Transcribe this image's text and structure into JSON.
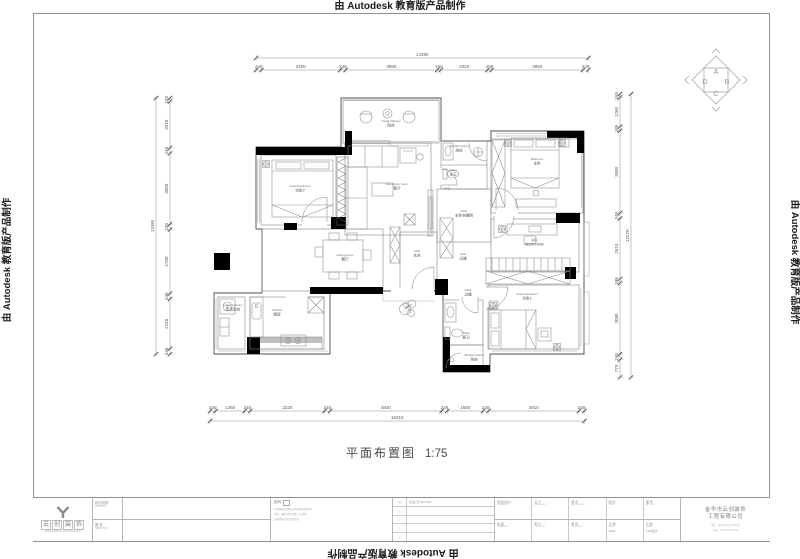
{
  "watermarks": {
    "top": "由 Autodesk 教育版产品制作",
    "bottom": "由 Autodesk 教育版产品制作",
    "left": "由 Autodesk 教育版产品制作",
    "right": "由 Autodesk 教育版产品制作"
  },
  "plan_title": {
    "name": "平面布置图",
    "scale": "1:75"
  },
  "orientation_symbol": {
    "top": "A",
    "right": "B",
    "bottom": "C",
    "left": "D"
  },
  "dimensions": {
    "top": {
      "total": "14390",
      "segments": [
        "240",
        "3400",
        "240",
        "3960",
        "160",
        "2020",
        "180",
        "3950",
        "240"
      ]
    },
    "bottom": {
      "total": "16210",
      "segments": [
        "240",
        "1260",
        "240",
        "3220",
        "240",
        "4830",
        "240",
        "1550",
        "240",
        "3910",
        "240"
      ]
    },
    "left": {
      "total": "11090",
      "segments": [
        "150",
        "2010",
        "240",
        "3060",
        "240",
        "2760",
        "240",
        "2150",
        "240"
      ]
    },
    "right": {
      "total": "12270",
      "segments": [
        "150",
        "1260",
        "180",
        "3560",
        "240",
        "2610",
        "180",
        "3080",
        "240",
        "770"
      ]
    }
  },
  "interior_dims": [
    {
      "text": "770",
      "x": 447,
      "y": 190
    }
  ],
  "rooms": [
    {
      "l1": "Living balcony",
      "l2": "阳台",
      "x": 391,
      "y": 122
    },
    {
      "l1": "Guest bedroom",
      "l2": "次卧2",
      "x": 300,
      "y": 187
    },
    {
      "l1": "Reception room",
      "l2": "客厅",
      "x": 397,
      "y": 185
    },
    {
      "l1": "Shower Room",
      "l2": "淋浴",
      "x": 459,
      "y": 147
    },
    {
      "l1": "Toilet",
      "l2": "主卫",
      "x": 453,
      "y": 171
    },
    {
      "l1": "Bedroom",
      "l2": "主卧",
      "x": 537,
      "y": 160
    },
    {
      "l1": "Aisle",
      "l2": "主卧衣帽间",
      "x": 464,
      "y": 212
    },
    {
      "l1": "Aisle",
      "l2": "玄关",
      "x": 417,
      "y": 252
    },
    {
      "l1": "Aisle",
      "l2": "过道",
      "x": 463,
      "y": 255
    },
    {
      "l1": "Aisle",
      "l2": "过道",
      "x": 468,
      "y": 291
    },
    {
      "l1": "书房",
      "l2": "BEDROOM",
      "x": 534,
      "y": 241
    },
    {
      "l1": "Dining room",
      "l2": "餐厅",
      "x": 345,
      "y": 256
    },
    {
      "l1": "Kitchen",
      "l2": "厨房",
      "x": 277,
      "y": 311
    },
    {
      "l1": "Living balcony",
      "l2": "生活阳台",
      "x": 233,
      "y": 306
    },
    {
      "l1": "Guest bedroom",
      "l2": "次卧1",
      "x": 527,
      "y": 295
    },
    {
      "l1": "Toilet",
      "l2": "客卫",
      "x": 466,
      "y": 334
    },
    {
      "l1": "Shower Room",
      "l2": "淋浴",
      "x": 474,
      "y": 356
    }
  ],
  "title_block": {
    "logo": {
      "chars": [
        "云",
        "创",
        "装",
        "饰"
      ],
      "tagline": "YUNCHUANG DECORATION"
    },
    "project_label": {
      "cn": "项目名称",
      "en": "PROJECT"
    },
    "drawing_label": {
      "cn": "图 名",
      "en": "DRAW TITL"
    },
    "stamp": {
      "title": "图例",
      "lines": [
        "凡本图纸未经本公司书面同意不得",
        "复制、翻印或转交第三方使用",
        "违者将追究其法律责任"
      ]
    },
    "revision": {
      "no_header": "№",
      "header": "修改记录 RECORD",
      "mark": "△",
      "rows": 4
    },
    "fields": [
      [
        {
          "cn": "项目负责人",
          "en": "T.PERSON",
          "val": ""
        },
        {
          "cn": "设 计",
          "en": "DESIGN BY",
          "val": ""
        },
        {
          "cn": "审 定",
          "en": "APPROVE BY",
          "val": ""
        },
        {
          "cn": "图 别",
          "en": "DWG",
          "val": ""
        },
        {
          "cn": "图 号",
          "en": "DET NO.",
          "val": ""
        }
      ],
      [
        {
          "cn": "制 图",
          "en": "DRAWN BY",
          "val": ""
        },
        {
          "cn": "客 户",
          "en": "CLIENT BY",
          "val": ""
        },
        {
          "cn": "审 核",
          "en": "CHECK BY",
          "val": ""
        },
        {
          "cn": "日 期",
          "en": "DATE",
          "val": "2023"
        },
        {
          "cn": "比 例",
          "en": "SCALE",
          "val": "1:80设计"
        }
      ]
    ],
    "company": {
      "line1": "金华市云创装饰",
      "line2": "工程有限公司",
      "contact1": "地址：金华市金东区XXXX号",
      "contact2": "电话：0579-XXXXXXXX"
    }
  }
}
